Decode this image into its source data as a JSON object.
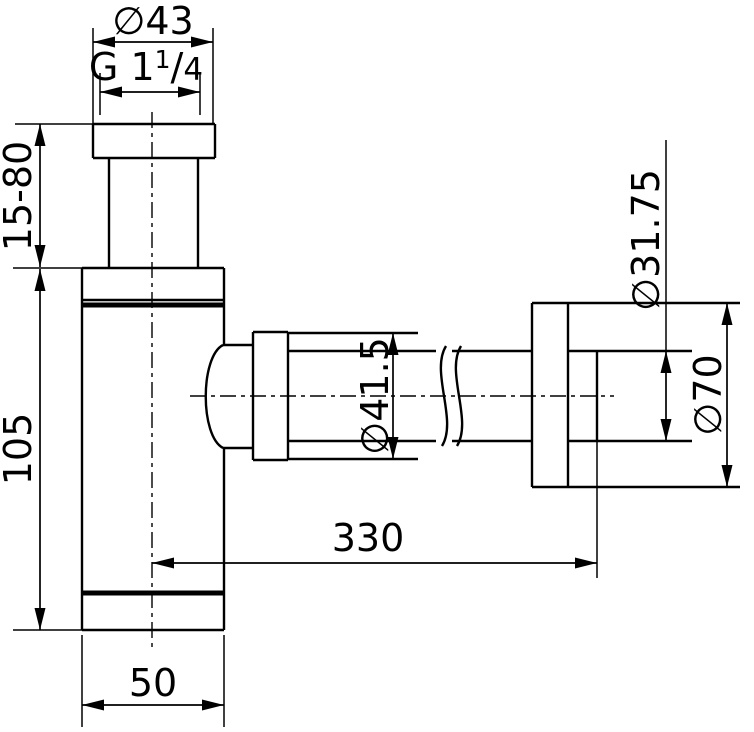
{
  "drawing": {
    "type": "technical-dimension-drawing",
    "subject": "bottle trap siphon side view with wall outlet",
    "colors": {
      "line": "#000000",
      "background": "#ffffff"
    },
    "labels": {
      "top_diameter": "∅43",
      "thread_prefix": "G 1",
      "thread_numerator": "1",
      "thread_slash": "/",
      "thread_denominator": "4",
      "inlet_height_range": "15-80",
      "body_height": "105",
      "outlet_diameter": "∅41.5",
      "wall_tube_diameter": "∅31.75",
      "wall_flange_diameter": "∅70",
      "horizontal_length": "330",
      "body_width": "50"
    }
  }
}
